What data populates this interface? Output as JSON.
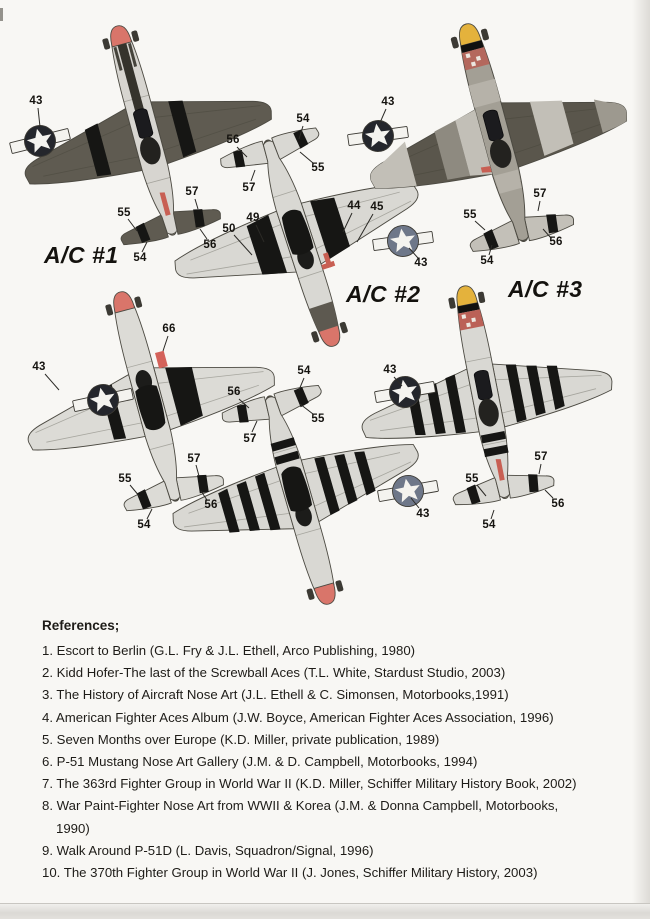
{
  "aircraft": [
    {
      "label": "A/C #1",
      "view": "top view, olive drab, red spinner",
      "callouts": [
        "43",
        "55",
        "54",
        "57",
        "56"
      ]
    },
    {
      "label": "A/C #2",
      "view": "bottom view, natural metal, red spinner",
      "callouts": [
        "56",
        "54",
        "55",
        "57",
        "50",
        "49",
        "44",
        "45",
        "43"
      ]
    },
    {
      "label": "A/C #3",
      "view": "top view, banded camouflage, yellow spinner",
      "callouts": [
        "43",
        "55",
        "57",
        "56",
        "54"
      ]
    },
    {
      "view": "bottom view, natural metal, red spinner",
      "callouts": [
        "43",
        "66",
        "55",
        "57",
        "54",
        "56"
      ]
    },
    {
      "view": "top view, natural metal with invasion stripes, yellow spinner",
      "callouts": [
        "43",
        "55",
        "57",
        "54",
        "56"
      ]
    },
    {
      "view": "bottom view, natural metal with invasion stripes, red spinner",
      "callouts": [
        "56",
        "54",
        "55",
        "57",
        "43"
      ]
    }
  ],
  "references": {
    "title": "References;",
    "items": [
      "1. Escort to Berlin (G.L. Fry & J.L. Ethell, Arco Publishing, 1980)",
      "2. Kidd Hofer-The last of the Screwball Aces (T.L. White, Stardust Studio, 2003)",
      "3. The History of Aircraft Nose Art (J.L. Ethell & C. Simonsen, Motorbooks,1991)",
      "4. American Fighter Aces Album (J.W. Boyce, American Fighter Aces Association, 1996)",
      "5. Seven Months over Europe (K.D. Miller, private publication, 1989)",
      "6. P-51 Mustang Nose Art Gallery (J.M. & D. Campbell, Motorbooks, 1994)",
      "7. The 363rd Fighter Group in World War II (K.D. Miller, Schiffer Military History Book, 2002)",
      "8. War Paint-Fighter Nose Art from WWII & Korea (J.M. & Donna Campbell, Motorbooks, 1990)",
      "9. Walk Around P-51D (L. Davis, Squadron/Signal, 1996)",
      "10. The 370th Fighter Group in World War II (J. Jones, Schiffer Military History, 2003)"
    ]
  },
  "colors": {
    "paper": "#f8f7f4",
    "spinner_red": "#d9756a",
    "spinner_yellow": "#e4b23c",
    "olive_drab": "#5f5b51",
    "natural_metal": "#d9d8d3",
    "invasion_stripe_black": "#161614",
    "insignia_dark": "#24262c",
    "insignia_gray_blue": "#6e7789"
  }
}
